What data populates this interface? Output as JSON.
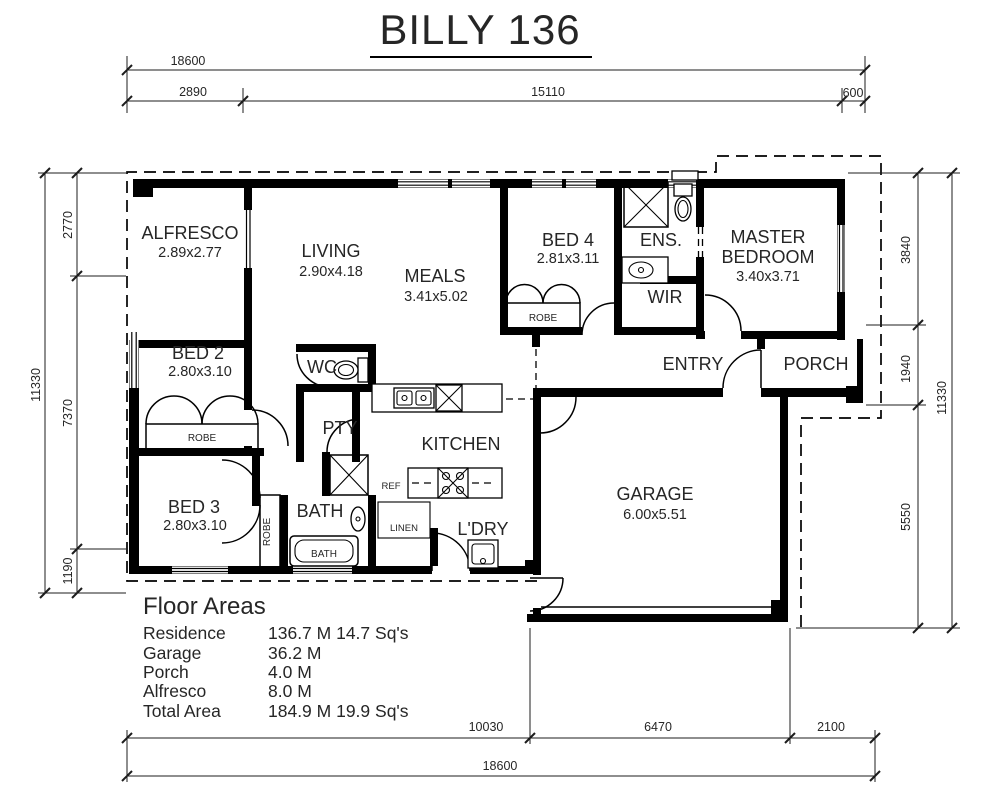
{
  "title": "BILLY 136",
  "dimensions": {
    "top": {
      "overall": "18600",
      "segments": [
        "2890",
        "15110",
        "600"
      ]
    },
    "bottom": {
      "overall": "18600",
      "segments": [
        "10030",
        "6470",
        "2100"
      ]
    },
    "left": {
      "overall": "11330",
      "segments": [
        "2770",
        "7370",
        "1190"
      ]
    },
    "right": {
      "overall": "11330",
      "segments": [
        "3840",
        "1940",
        "5550"
      ]
    }
  },
  "rooms": {
    "alfresco": {
      "name": "ALFRESCO",
      "size": "2.89x2.77"
    },
    "living": {
      "name": "LIVING",
      "size": "2.90x4.18"
    },
    "meals": {
      "name": "MEALS",
      "size": "3.41x5.02"
    },
    "bed2": {
      "name": "BED 2",
      "size": "2.80x3.10"
    },
    "bed3": {
      "name": "BED 3",
      "size": "2.80x3.10"
    },
    "bed4": {
      "name": "BED 4",
      "size": "2.81x3.11"
    },
    "master": {
      "line1": "MASTER",
      "line2": "BEDROOM",
      "size": "3.40x3.71"
    },
    "garage": {
      "name": "GARAGE",
      "size": "6.00x5.51"
    },
    "kitchen": {
      "name": "KITCHEN"
    },
    "entry": {
      "name": "ENTRY"
    },
    "porch": {
      "name": "PORCH"
    },
    "ens": {
      "name": "ENS."
    },
    "wir": {
      "name": "WIR"
    },
    "wc": {
      "name": "WC"
    },
    "pty": {
      "name": "PTY"
    },
    "bath": {
      "name": "BATH"
    },
    "ldry": {
      "name": "L'DRY"
    }
  },
  "fixtures": {
    "robe": "ROBE",
    "linen": "LINEN",
    "ref": "REF",
    "bathtub": "BATH"
  },
  "floor_areas": {
    "heading": "Floor Areas",
    "rows": [
      {
        "label": "Residence",
        "value": "136.7 M 14.7 Sq's"
      },
      {
        "label": "Garage",
        "value": "36.2 M"
      },
      {
        "label": "Porch",
        "value": "4.0 M"
      },
      {
        "label": "Alfresco",
        "value": "8.0 M"
      },
      {
        "label": "Total Area",
        "value": "184.9 M 19.9 Sq's"
      }
    ]
  }
}
